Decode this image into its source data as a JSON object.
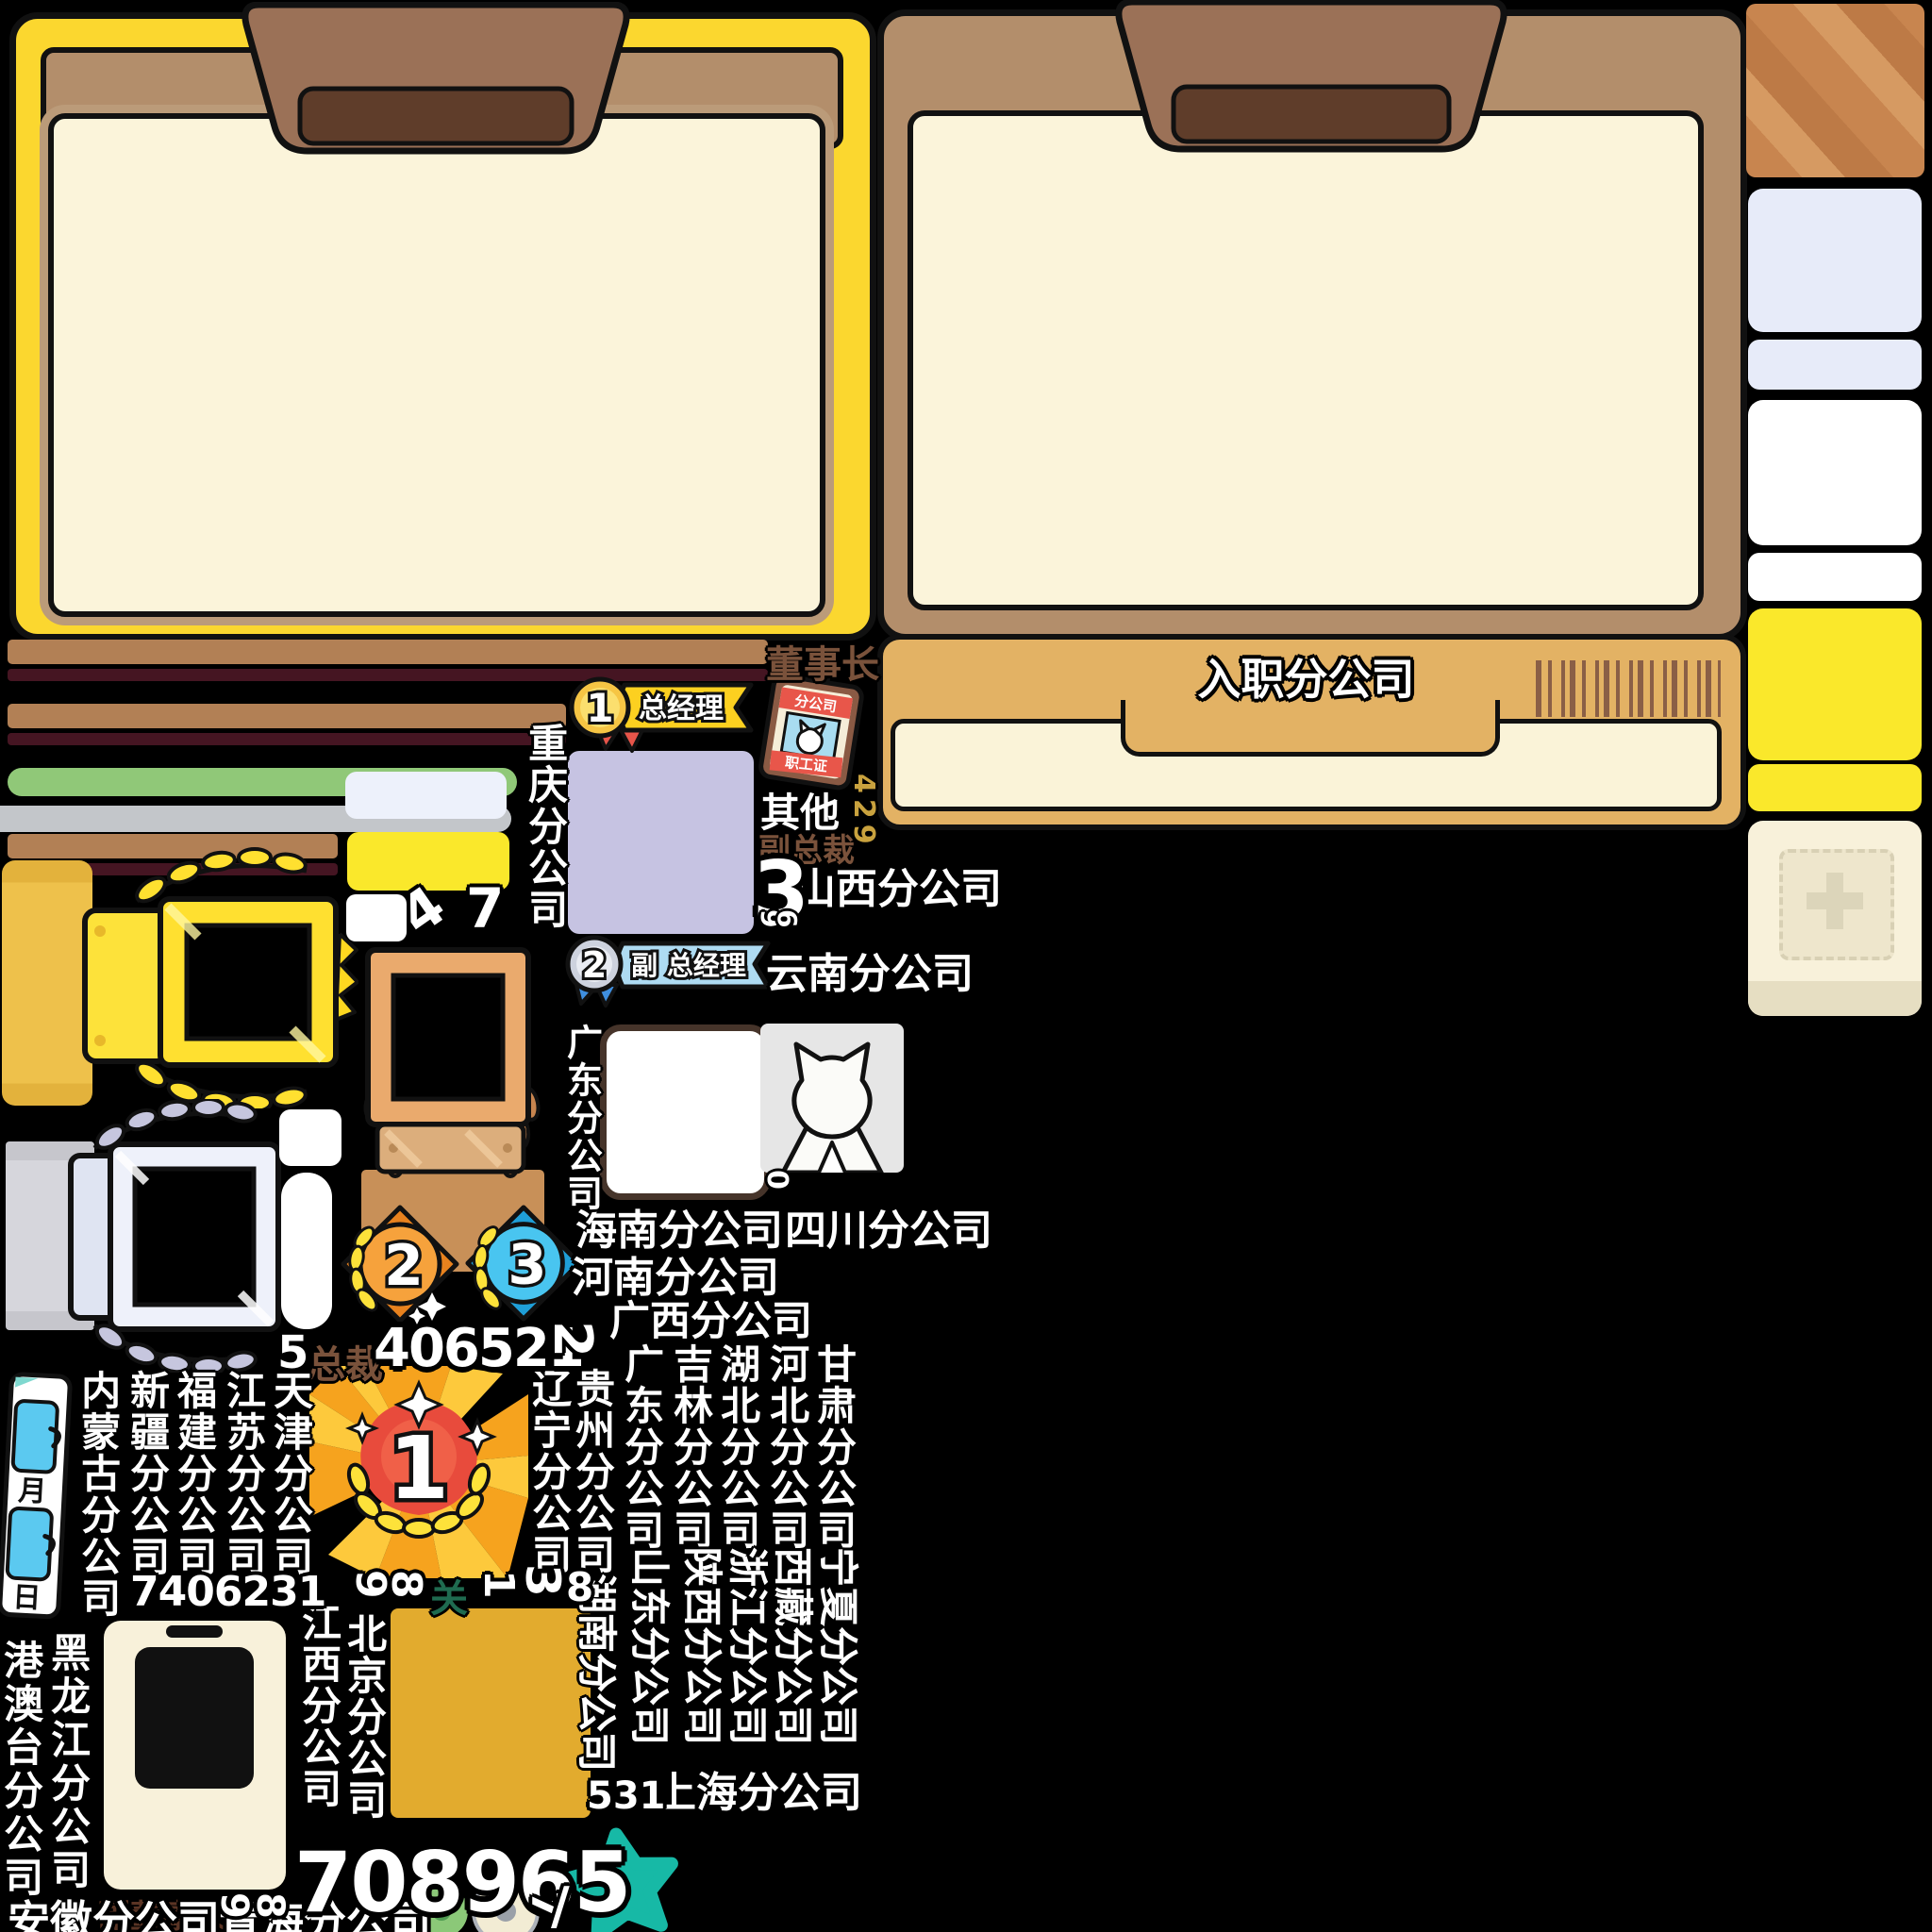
{
  "colors": {
    "background": "#000000",
    "panel_yellow": "#fbd72f",
    "panel_brown": "#b38e6b",
    "tab_brown": "#9b7157",
    "tab_inner_brown": "#5f3d2a",
    "panel_cream": "#fbf4da",
    "header_tan": "#e3b264",
    "bar_tan": "#b28055",
    "bar_maroon": "#451522",
    "bar_green": "#90c878",
    "bar_gray": "#c3c6ca",
    "lavender_tile": "#c6c3e2",
    "bluewhite_tile": "#edf1fb",
    "yellow_tile": "#fae82b",
    "amber_tile": "#e2ab2e",
    "gold": "#ffe030",
    "silver": "#e7eaf6",
    "peach_frame": "#eaaa6d",
    "teal_star": "#17b9a6",
    "medal_gold": "#f6c544",
    "medal_silver": "#cdd2de",
    "star_orange": "#f6a23c",
    "star_blue": "#49c5f0",
    "banner_yellow": "#fcd020",
    "banner_blue": "#aedbf2",
    "idcard_red": "#e8564a",
    "barcode_brown": "#8a5f46"
  },
  "header": {
    "title": "入职分公司"
  },
  "ranks": {
    "chairman": "董事长",
    "general_manager": "总经理",
    "deputy_general_manager": "副 总经理",
    "president": "总裁",
    "vice_president": "副总裁",
    "vice_chairman": "副董事长"
  },
  "id_card": {
    "top": "分公司",
    "bottom": "职工证"
  },
  "calendar": {
    "month": "月",
    "day": "日"
  },
  "medals": {
    "first": "1",
    "second": "2",
    "third": "3",
    "big_first": "1"
  },
  "misc": {
    "other": "其他",
    "pass": "关",
    "slash": "/"
  },
  "numbers": {
    "n429": "429",
    "n3": "3",
    "n9a": "9",
    "n6a": "6",
    "n4": "4",
    "n7": "7",
    "n5": "5",
    "n406521": "406521",
    "n2": "2",
    "n0": "0",
    "n7406231": "7406231",
    "n9b": "9",
    "n8b": "8",
    "n1": "1",
    "n3s": "3",
    "n8": "8",
    "n708965": "708965",
    "n9c": "9",
    "n8c": "8",
    "n531": "531",
    "n7s": "7"
  },
  "branches": {
    "shanxi": "山西分公司",
    "yunnan": "云南分公司",
    "hainan": "海南分公司",
    "sichuan": "四川分公司",
    "henan": "河南分公司",
    "guangxi": "广西分公司",
    "shanghai": "上海分公司",
    "anhui": "安徽分公司",
    "qinghai": "青海分公司",
    "chongqing": "重庆分公司",
    "guangdong_a": "广东分公司",
    "tianjin": "天津分公司",
    "jiangsu": "江苏分公司",
    "fujian": "福建分公司",
    "xinjiang": "新疆分公司",
    "neimenggu": "内蒙古分公司",
    "gansu": "甘肃分公司",
    "hebei": "河北分公司",
    "hubei": "湖北分公司",
    "jilin": "吉林分公司",
    "guangdong_b": "广东分公司",
    "guizhou": "贵州分公司",
    "liaoning": "辽宁分公司",
    "jiangxi": "江西分公司",
    "beijing": "北京分公司",
    "heilongjiang": "黑龙江分公司",
    "gangaotai": "港澳台分公司",
    "ningxia": "宁夏分公司",
    "xizang": "西藏分公司",
    "zhejiang": "浙江分公司",
    "shaanxi": "陕西分公司",
    "shandong": "山东分公司",
    "hunan": "湖南分公司"
  }
}
